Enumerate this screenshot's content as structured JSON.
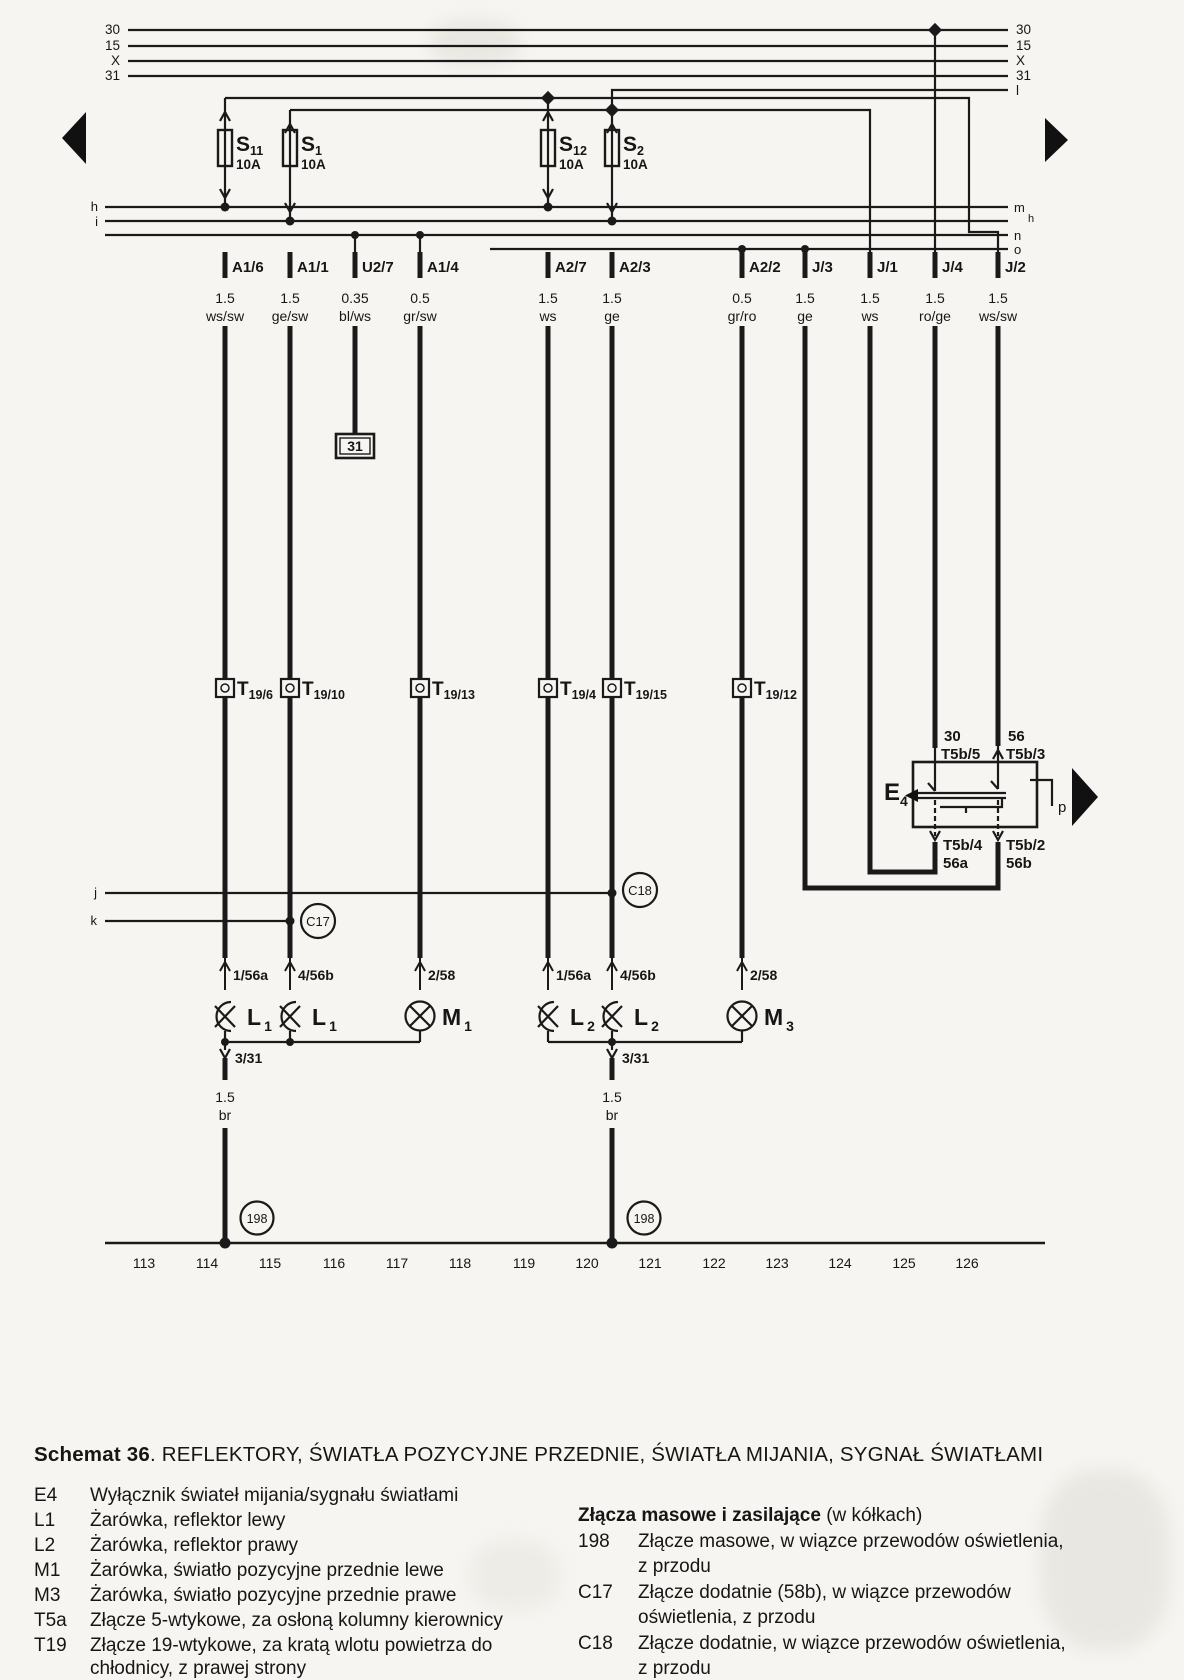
{
  "buses": {
    "left": [
      "30",
      "15",
      "X",
      "31"
    ],
    "right": [
      "30",
      "15",
      "X",
      "31",
      "l"
    ]
  },
  "rails": {
    "left": [
      "h",
      "i"
    ],
    "right": [
      "m",
      "h",
      "n",
      "o"
    ]
  },
  "fuses": [
    {
      "name": "S",
      "sub": "11",
      "amps": "10A"
    },
    {
      "name": "S",
      "sub": "1",
      "amps": "10A"
    },
    {
      "name": "S",
      "sub": "12",
      "amps": "10A"
    },
    {
      "name": "S",
      "sub": "2",
      "amps": "10A"
    }
  ],
  "connectors": [
    {
      "label": "A1/6",
      "gauge": "1.5",
      "color": "ws/sw"
    },
    {
      "label": "A1/1",
      "gauge": "1.5",
      "color": "ge/sw"
    },
    {
      "label": "U2/7",
      "gauge": "0.35",
      "color": "bl/ws"
    },
    {
      "label": "A1/4",
      "gauge": "0.5",
      "color": "gr/sw"
    },
    {
      "label": "A2/7",
      "gauge": "1.5",
      "color": "ws"
    },
    {
      "label": "A2/3",
      "gauge": "1.5",
      "color": "ge"
    },
    {
      "label": "A2/2",
      "gauge": "0.5",
      "color": "gr/ro"
    },
    {
      "label": "J/3",
      "gauge": "1.5",
      "color": "ge"
    },
    {
      "label": "J/1",
      "gauge": "1.5",
      "color": "ws"
    },
    {
      "label": "J/4",
      "gauge": "1.5",
      "color": "ro/ge"
    },
    {
      "label": "J/2",
      "gauge": "1.5",
      "color": "ws/sw"
    }
  ],
  "ground_box": "31",
  "t19": [
    {
      "name": "T",
      "sub": "19/6"
    },
    {
      "name": "T",
      "sub": "19/10"
    },
    {
      "name": "T",
      "sub": "19/13"
    },
    {
      "name": "T",
      "sub": "19/4"
    },
    {
      "name": "T",
      "sub": "19/15"
    },
    {
      "name": "T",
      "sub": "19/12"
    }
  ],
  "e4": {
    "name": "E",
    "sub": "4",
    "top_left_terminal": "30",
    "top_left_pin": "T5b/5",
    "top_right_terminal": "56",
    "top_right_pin": "T5b/3",
    "bottom_left_pin": "T5b/4",
    "bottom_left_terminal": "56a",
    "bottom_right_pin": "T5b/2",
    "bottom_right_terminal": "56b",
    "wiper": "p"
  },
  "branches": {
    "j": "j",
    "k": "k",
    "c17": "C17",
    "c18": "C18"
  },
  "bulbs": [
    {
      "terminal": "1/56a",
      "name": "L",
      "sub": "1"
    },
    {
      "terminal": "4/56b",
      "name": "L",
      "sub": "1"
    },
    {
      "terminal": "2/58",
      "name": "M",
      "sub": "1"
    },
    {
      "terminal": "1/56a",
      "name": "L",
      "sub": "2"
    },
    {
      "terminal": "4/56b",
      "name": "L",
      "sub": "2"
    },
    {
      "terminal": "2/58",
      "name": "M",
      "sub": "3"
    }
  ],
  "grounds": [
    {
      "terminal": "3/31",
      "gauge": "1.5",
      "color": "br",
      "node": "198"
    },
    {
      "terminal": "3/31",
      "gauge": "1.5",
      "color": "br",
      "node": "198"
    }
  ],
  "tracks": [
    "113",
    "114",
    "115",
    "116",
    "117",
    "118",
    "119",
    "120",
    "121",
    "122",
    "123",
    "124",
    "125",
    "126"
  ],
  "title": {
    "bold": "Schemat 36",
    "rest": ". REFLEKTORY, ŚWIATŁA POZYCYJNE PRZEDNIE, ŚWIATŁA MIJANIA, SYGNAŁ ŚWIATŁAMI"
  },
  "legend_left": [
    {
      "key": "E4",
      "text": "Wyłącznik świateł mijania/sygnału światłami"
    },
    {
      "key": "L1",
      "text": "Żarówka, reflektor lewy"
    },
    {
      "key": "L2",
      "text": "Żarówka, reflektor prawy"
    },
    {
      "key": "M1",
      "text": "Żarówka, światło pozycyjne przednie lewe"
    },
    {
      "key": "M3",
      "text": "Żarówka, światło pozycyjne przednie prawe"
    },
    {
      "key": "T5a",
      "text": "Złącze 5-wtykowe, za osłoną kolumny kierownicy"
    },
    {
      "key": "T19",
      "text": "Złącze 19-wtykowe, za kratą wlotu powietrza do",
      "text2": "chłodnicy, z prawej strony"
    }
  ],
  "legend_right": {
    "heading_bold": "Złącza masowe i zasilające",
    "heading_rest": " (w kółkach)",
    "items": [
      {
        "key": "198",
        "text": "Złącze masowe, w wiązce przewodów oświetlenia,",
        "text2": "z przodu"
      },
      {
        "key": "C17",
        "text": "Złącze dodatnie (58b), w wiązce przewodów",
        "text2": "oświetlenia, z przodu"
      },
      {
        "key": "C18",
        "text": "Złącze dodatnie, w wiązce przewodów oświetlenia,",
        "text2": "z przodu"
      }
    ]
  }
}
